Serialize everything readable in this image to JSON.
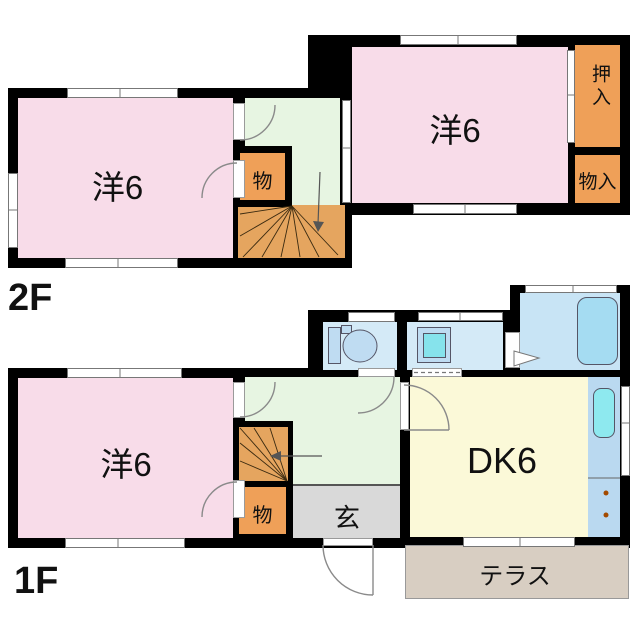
{
  "floors": {
    "second": {
      "label": "2F",
      "rooms": {
        "west_room": {
          "label": "洋6"
        },
        "east_room": {
          "label": "洋6"
        },
        "oshiire": {
          "label": "押入"
        },
        "monoire": {
          "label": "物入"
        },
        "storage": {
          "label": "物"
        }
      }
    },
    "first": {
      "label": "1F",
      "rooms": {
        "west_room": {
          "label": "洋6"
        },
        "dining_kitchen": {
          "label": "DK6"
        },
        "genkan": {
          "label": "玄"
        },
        "storage": {
          "label": "物"
        },
        "terrace": {
          "label": "テラス"
        }
      }
    }
  },
  "colors": {
    "wall": "#000000",
    "western_room_pink": "#f8dce9",
    "hall_green": "#e7f5e2",
    "closet_orange": "#efa058",
    "stairs_orange": "#e5a55f",
    "dk_yellow": "#fbf9d8",
    "sanitary_blue": "#d4eaf7",
    "bath_blue": "#c8e4f5",
    "fixture_blue": "#bfdcf2",
    "sink_teal": "#86e3ec",
    "genkan_gray": "#d9d9d9",
    "terrace_beige": "#d8cec2"
  }
}
